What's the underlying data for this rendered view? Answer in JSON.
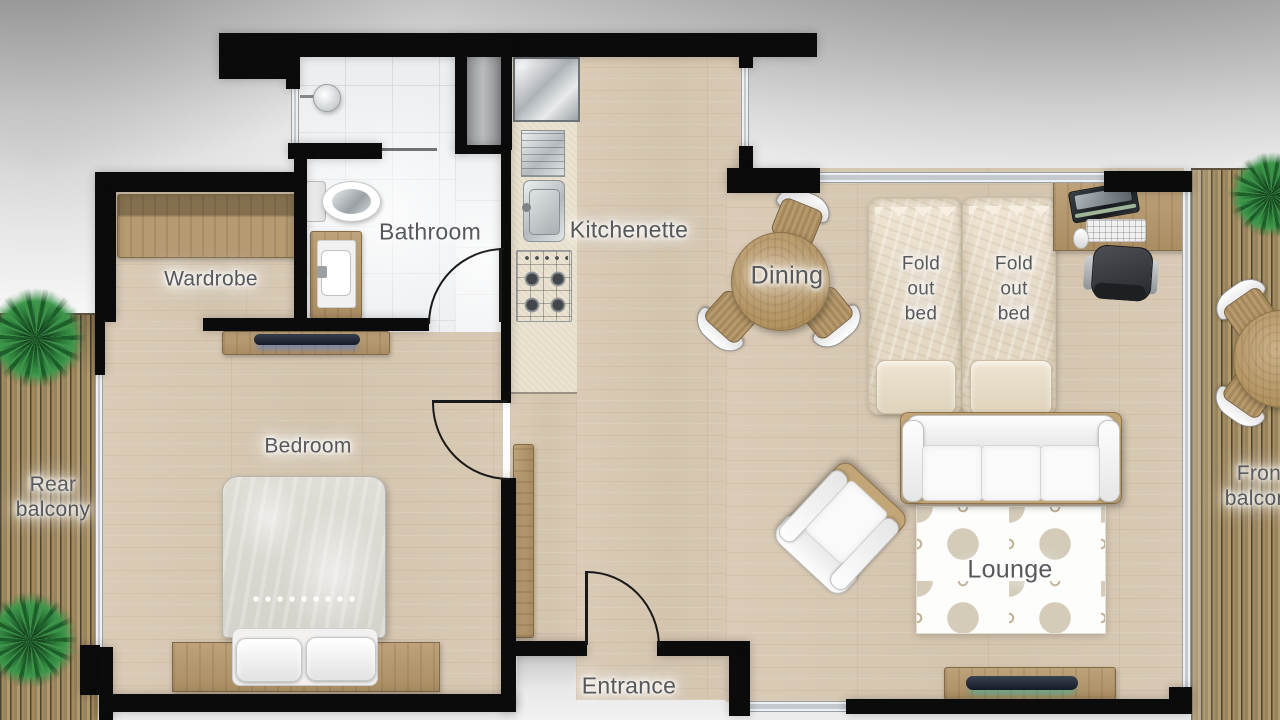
{
  "title": "Studio apartment floor plan",
  "rooms": {
    "wardrobe": {
      "label": "Wardrobe"
    },
    "bathroom": {
      "label": "Bathroom"
    },
    "kitchenette": {
      "label": "Kitchenette"
    },
    "dining": {
      "label": "Dining"
    },
    "bedroom": {
      "label": "Bedroom"
    },
    "lounge": {
      "label": "Lounge"
    },
    "entrance": {
      "label": "Entrance"
    },
    "rear_balcony": {
      "line1": "Rear",
      "line2": "balcony"
    },
    "front_balcony": {
      "line1": "Front",
      "line2": "balcony"
    },
    "fold_out_bed_left": {
      "line1": "Fold",
      "line2": "out",
      "line3": "bed"
    },
    "fold_out_bed_right": {
      "line1": "Fold",
      "line2": "out",
      "line3": "bed"
    }
  },
  "palette": {
    "wall": "#0b0b0b",
    "wood_floor": "#d7c8b3",
    "deck_wood": "#97835c",
    "tile": "#eceef0",
    "counter": "#eae3d1",
    "label_text": "#56585b",
    "furniture_wood": "#b3966b",
    "white_furniture": "#f7f7f7",
    "glass": "#e6eaec",
    "plant_green": "#2e7d3a",
    "tv_glow": "#35c8b4",
    "outside": "#ededed"
  }
}
